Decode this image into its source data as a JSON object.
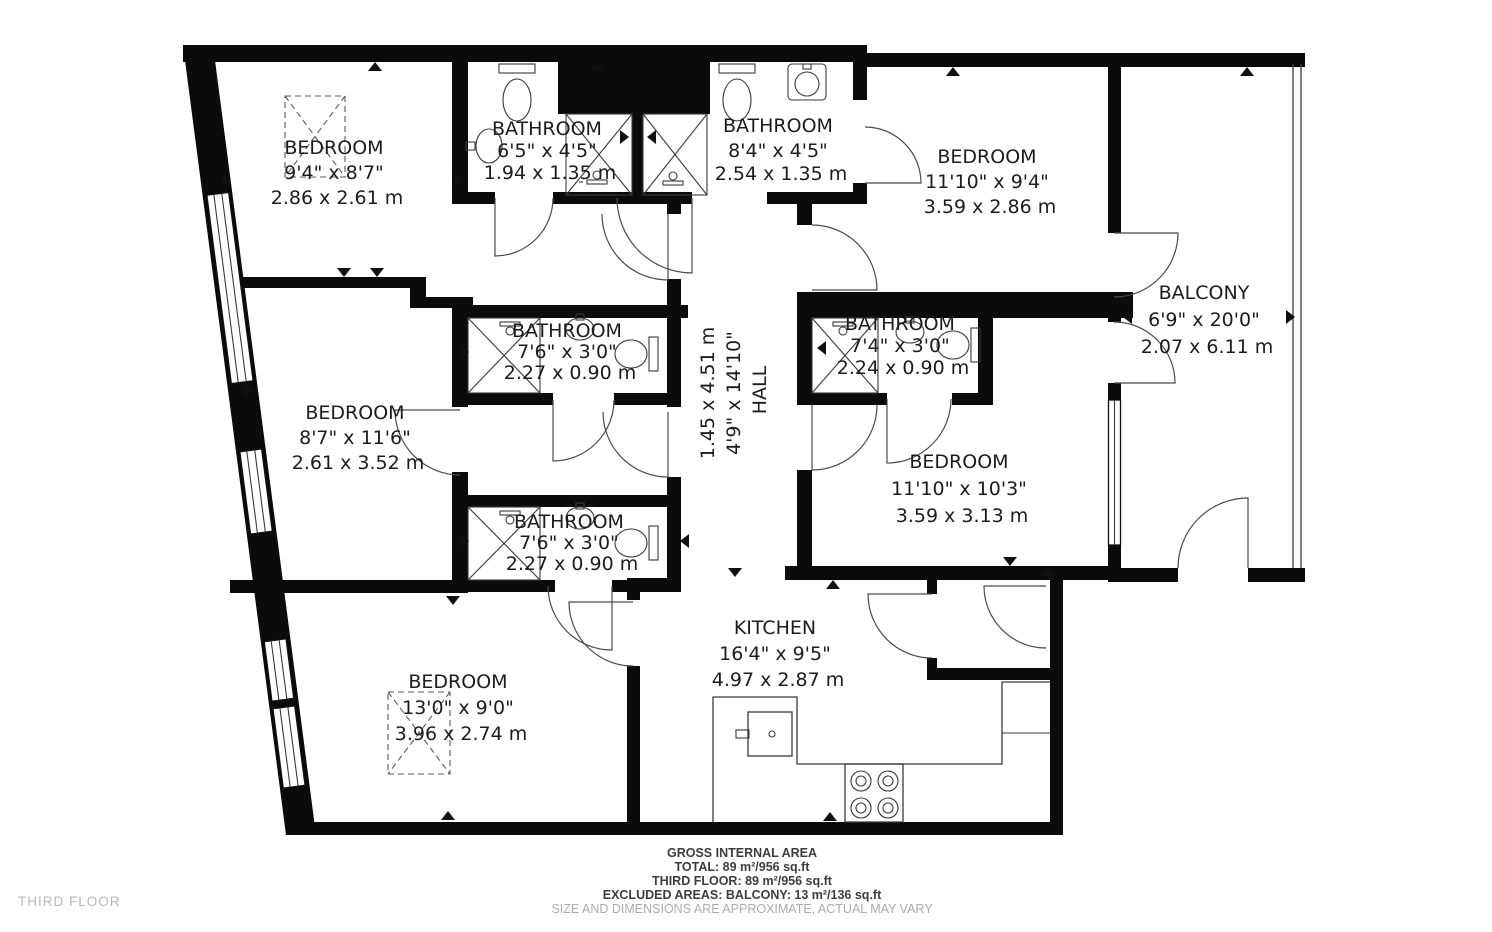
{
  "floor_plan": {
    "floor_label": "THIRD FLOOR",
    "rooms": [
      {
        "id": "bedroom-top-left",
        "name": "BEDROOM",
        "imperial": "9'4\" x 8'7\"",
        "metric": "2.86 x 2.61 m"
      },
      {
        "id": "bathroom-top-1",
        "name": "BATHROOM",
        "imperial": "6'5\" x 4'5\"",
        "metric": "1.94 x 1.35 m"
      },
      {
        "id": "bathroom-top-2",
        "name": "BATHROOM",
        "imperial": "8'4\" x 4'5\"",
        "metric": "2.54 x 1.35 m"
      },
      {
        "id": "bedroom-top-right",
        "name": "BEDROOM",
        "imperial": "11'10\" x 9'4\"",
        "metric": "3.59 x 2.86 m"
      },
      {
        "id": "balcony",
        "name": "BALCONY",
        "imperial": "6'9\" x 20'0\"",
        "metric": "2.07 x 6.11 m"
      },
      {
        "id": "hall",
        "name": "HALL",
        "imperial": "4'9\" x 14'10\"",
        "metric": "1.45 x 4.51 m"
      },
      {
        "id": "bedroom-middle-left",
        "name": "BEDROOM",
        "imperial": "8'7\" x 11'6\"",
        "metric": "2.61 x 3.52 m"
      },
      {
        "id": "bathroom-middle-top",
        "name": "BATHROOM",
        "imperial": "7'6\" x 3'0\"",
        "metric": "2.27 x 0.90 m"
      },
      {
        "id": "bathroom-right",
        "name": "BATHROOM",
        "imperial": "7'4\" x 3'0\"",
        "metric": "2.24 x 0.90 m"
      },
      {
        "id": "bedroom-middle-right",
        "name": "BEDROOM",
        "imperial": "11'10\" x 10'3\"",
        "metric": "3.59 x 3.13 m"
      },
      {
        "id": "bathroom-middle-bottom",
        "name": "BATHROOM",
        "imperial": "7'6\" x 3'0\"",
        "metric": "2.27 x 0.90 m"
      },
      {
        "id": "bedroom-bottom-left",
        "name": "BEDROOM",
        "imperial": "13'0\" x 9'0\"",
        "metric": "3.96 x 2.74 m"
      },
      {
        "id": "kitchen",
        "name": "KITCHEN",
        "imperial": "16'4\" x 9'5\"",
        "metric": "4.97 x 2.87 m"
      }
    ],
    "footer": {
      "title": "GROSS INTERNAL AREA",
      "total": "TOTAL: 89 m²/956 sq.ft",
      "floor": "THIRD FLOOR: 89 m²/956 sq.ft",
      "excluded": "EXCLUDED AREAS: BALCONY: 13 m²/136 sq.ft",
      "disclaimer": "SIZE AND DIMENSIONS ARE APPROXIMATE, ACTUAL MAY VARY"
    },
    "colors": {
      "wall": "#0b0b0b",
      "line": "#3a3a3a",
      "muted": "#ababab",
      "background": "#ffffff"
    }
  }
}
